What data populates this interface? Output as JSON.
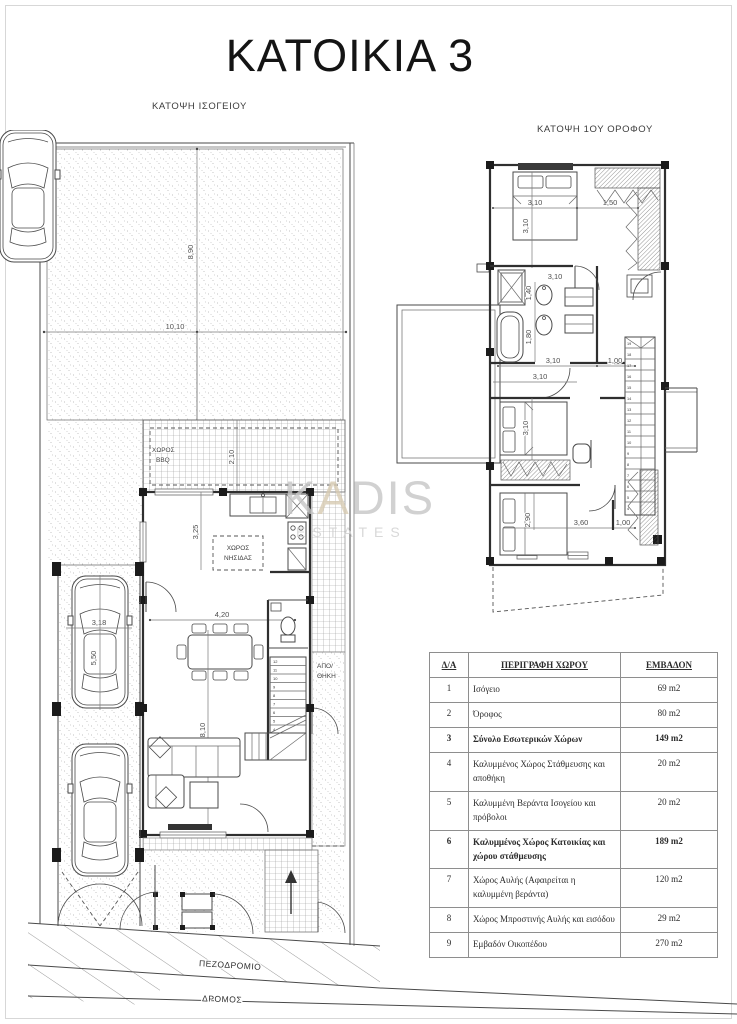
{
  "page": {
    "title": "ΚΑΤΟΙΚΙΑ 3"
  },
  "watermark": {
    "k": "K",
    "a": "A",
    "dis": "DIS",
    "estates": "ESTATES"
  },
  "ground_plan": {
    "label": "ΚΑΤΟΨΗ ΙΣΟΓΕΙΟΥ",
    "rooms": {
      "bbq1": "ΧΩΡΟΣ",
      "bbq2": "BBQ",
      "island1": "ΧΩΡΟΣ",
      "island2": "ΝΗΣΙΔΑΣ",
      "storage1": "ΑΠΟ/",
      "storage2": "ΘΗΚΗ"
    },
    "site": {
      "sidewalk": "ΠΕΖΟΔΡΟΜΙΟ",
      "road": "ΔΡΟΜΟΣ"
    },
    "dims": {
      "yard_depth": "8,90",
      "yard_width": "10,10",
      "bbq_depth": "2,10",
      "kitchen_depth": "3,25",
      "dining_width": "4,20",
      "living_depth": "8,10",
      "carport_width": "3,18",
      "carport_length": "5,50"
    },
    "stairs": [
      "12",
      "11",
      "10",
      "9",
      "8",
      "7",
      "6",
      "5",
      "4"
    ]
  },
  "first_plan": {
    "label": "ΚΑΤΟΨΗ 1ΟΥ ΟΡΟΦΟΥ",
    "dims": {
      "bed1_w": "3,10",
      "bed1_d": "3,10",
      "closet_w": "1,50",
      "bath_w": "1,40",
      "bath_d": "1,80",
      "hall_w": "3,10",
      "hall_d": "1,00",
      "bed2_w": "3,10",
      "bed2_d": "3,10",
      "bed3_d": "2,90",
      "bed3_w": "3,60",
      "closet3_w": "1,00"
    },
    "stairs": [
      "19",
      "18",
      "17",
      "16",
      "15",
      "14",
      "13",
      "12",
      "11",
      "10",
      "9",
      "8",
      "7",
      "6",
      "5",
      "4"
    ]
  },
  "area_table": {
    "header": {
      "no": "Δ/Α",
      "desc": "ΠΕΡΙΓΡΑΦΗ ΧΩΡΟΥ",
      "area": "ΕΜΒΑΔΟΝ"
    },
    "rows": [
      {
        "no": "1",
        "desc": "Ισόγειο",
        "area": "69 m2"
      },
      {
        "no": "2",
        "desc": "Όροφος",
        "area": "80 m2"
      },
      {
        "no": "3",
        "desc": "Σύνολο Εσωτερικών Χώρων",
        "area": "149 m2"
      },
      {
        "no": "4",
        "desc": "Καλυμμένος Χώρος Στάθμευσης και αποθήκη",
        "area": "20 m2"
      },
      {
        "no": "5",
        "desc": "Καλυμμένη Βεράντα Ισογείου και πρόβολοι",
        "area": "20 m2"
      },
      {
        "no": "6",
        "desc": "Καλυμμένος Χώρος Κατοικίας και χώρου στάθμευσης",
        "area": "189 m2"
      },
      {
        "no": "7",
        "desc": "Χώρος Αυλής (Αφαιρείται η καλυμμένη βεράντα)",
        "area": "120 m2"
      },
      {
        "no": "8",
        "desc": "Χώρος Μπροστινής Αυλής και εισόδου",
        "area": "29 m2"
      },
      {
        "no": "9",
        "desc": "Εμβαδόν Οικοπέδου",
        "area": "270 m2"
      }
    ]
  }
}
